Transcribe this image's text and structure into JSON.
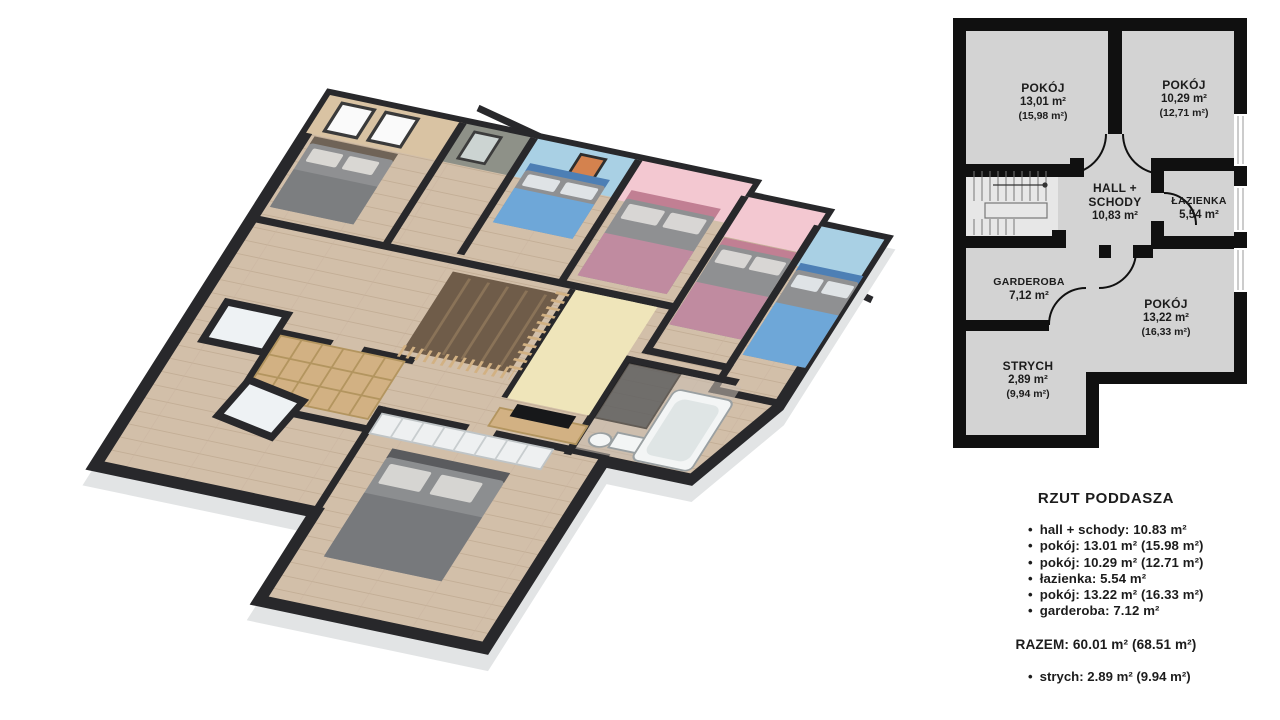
{
  "palette": {
    "ink": "#1c1c1c",
    "wall-dark": "#28282b",
    "facade": "#e2e4e5",
    "floor-wood": "#d2bfa9",
    "wall-beige": "#d9c3a3",
    "wall-stone": "#8e9188",
    "wall-blue": "#a9d0e4",
    "wall-pink": "#f3c8d1",
    "wall-cream": "#efe5ba",
    "bed-gray": "#8f9092",
    "blanket-pink": "#c08ba0",
    "blanket-blue": "#6ea7d8",
    "furniture-wood": "#d2b183",
    "fixture-white": "#f3f5f5",
    "plan-floor": "#d3d3d3",
    "plan-wall": "#101010"
  },
  "plan2d": {
    "rooms": [
      {
        "id": "pokoj-1",
        "lines": [
          "POKÓJ",
          "13,01 m²",
          "(15,98 m²)"
        ]
      },
      {
        "id": "pokoj-2",
        "lines": [
          "POKÓJ",
          "10,29 m²",
          "(12,71 m²)"
        ]
      },
      {
        "id": "hall",
        "lines": [
          "HALL +",
          "SCHODY",
          "10,83 m²"
        ]
      },
      {
        "id": "lazienka",
        "lines": [
          "ŁAZIENKA",
          "5,54 m²"
        ]
      },
      {
        "id": "garderoba",
        "lines": [
          "GARDEROBA",
          "7,12 m²"
        ]
      },
      {
        "id": "pokoj-3",
        "lines": [
          "POKÓJ",
          "13,22 m²",
          "(16,33 m²)"
        ]
      },
      {
        "id": "strych",
        "lines": [
          "STRYCH",
          "2,89 m²",
          "(9,94 m²)"
        ]
      }
    ]
  },
  "legend": {
    "title": "RZUT PODDASZA",
    "items": [
      "hall + schody: 10.83 m²",
      "pokój: 13.01 m² (15.98 m²)",
      "pokój: 10.29 m² (12.71 m²)",
      "łazienka: 5.54 m²",
      "pokój: 13.22 m² (16.33 m²)",
      "garderoba: 7.12 m²"
    ],
    "total": "RAZEM: 60.01 m² (68.51 m²)",
    "extra_item": "strych: 2.89 m² (9.94 m²)"
  }
}
